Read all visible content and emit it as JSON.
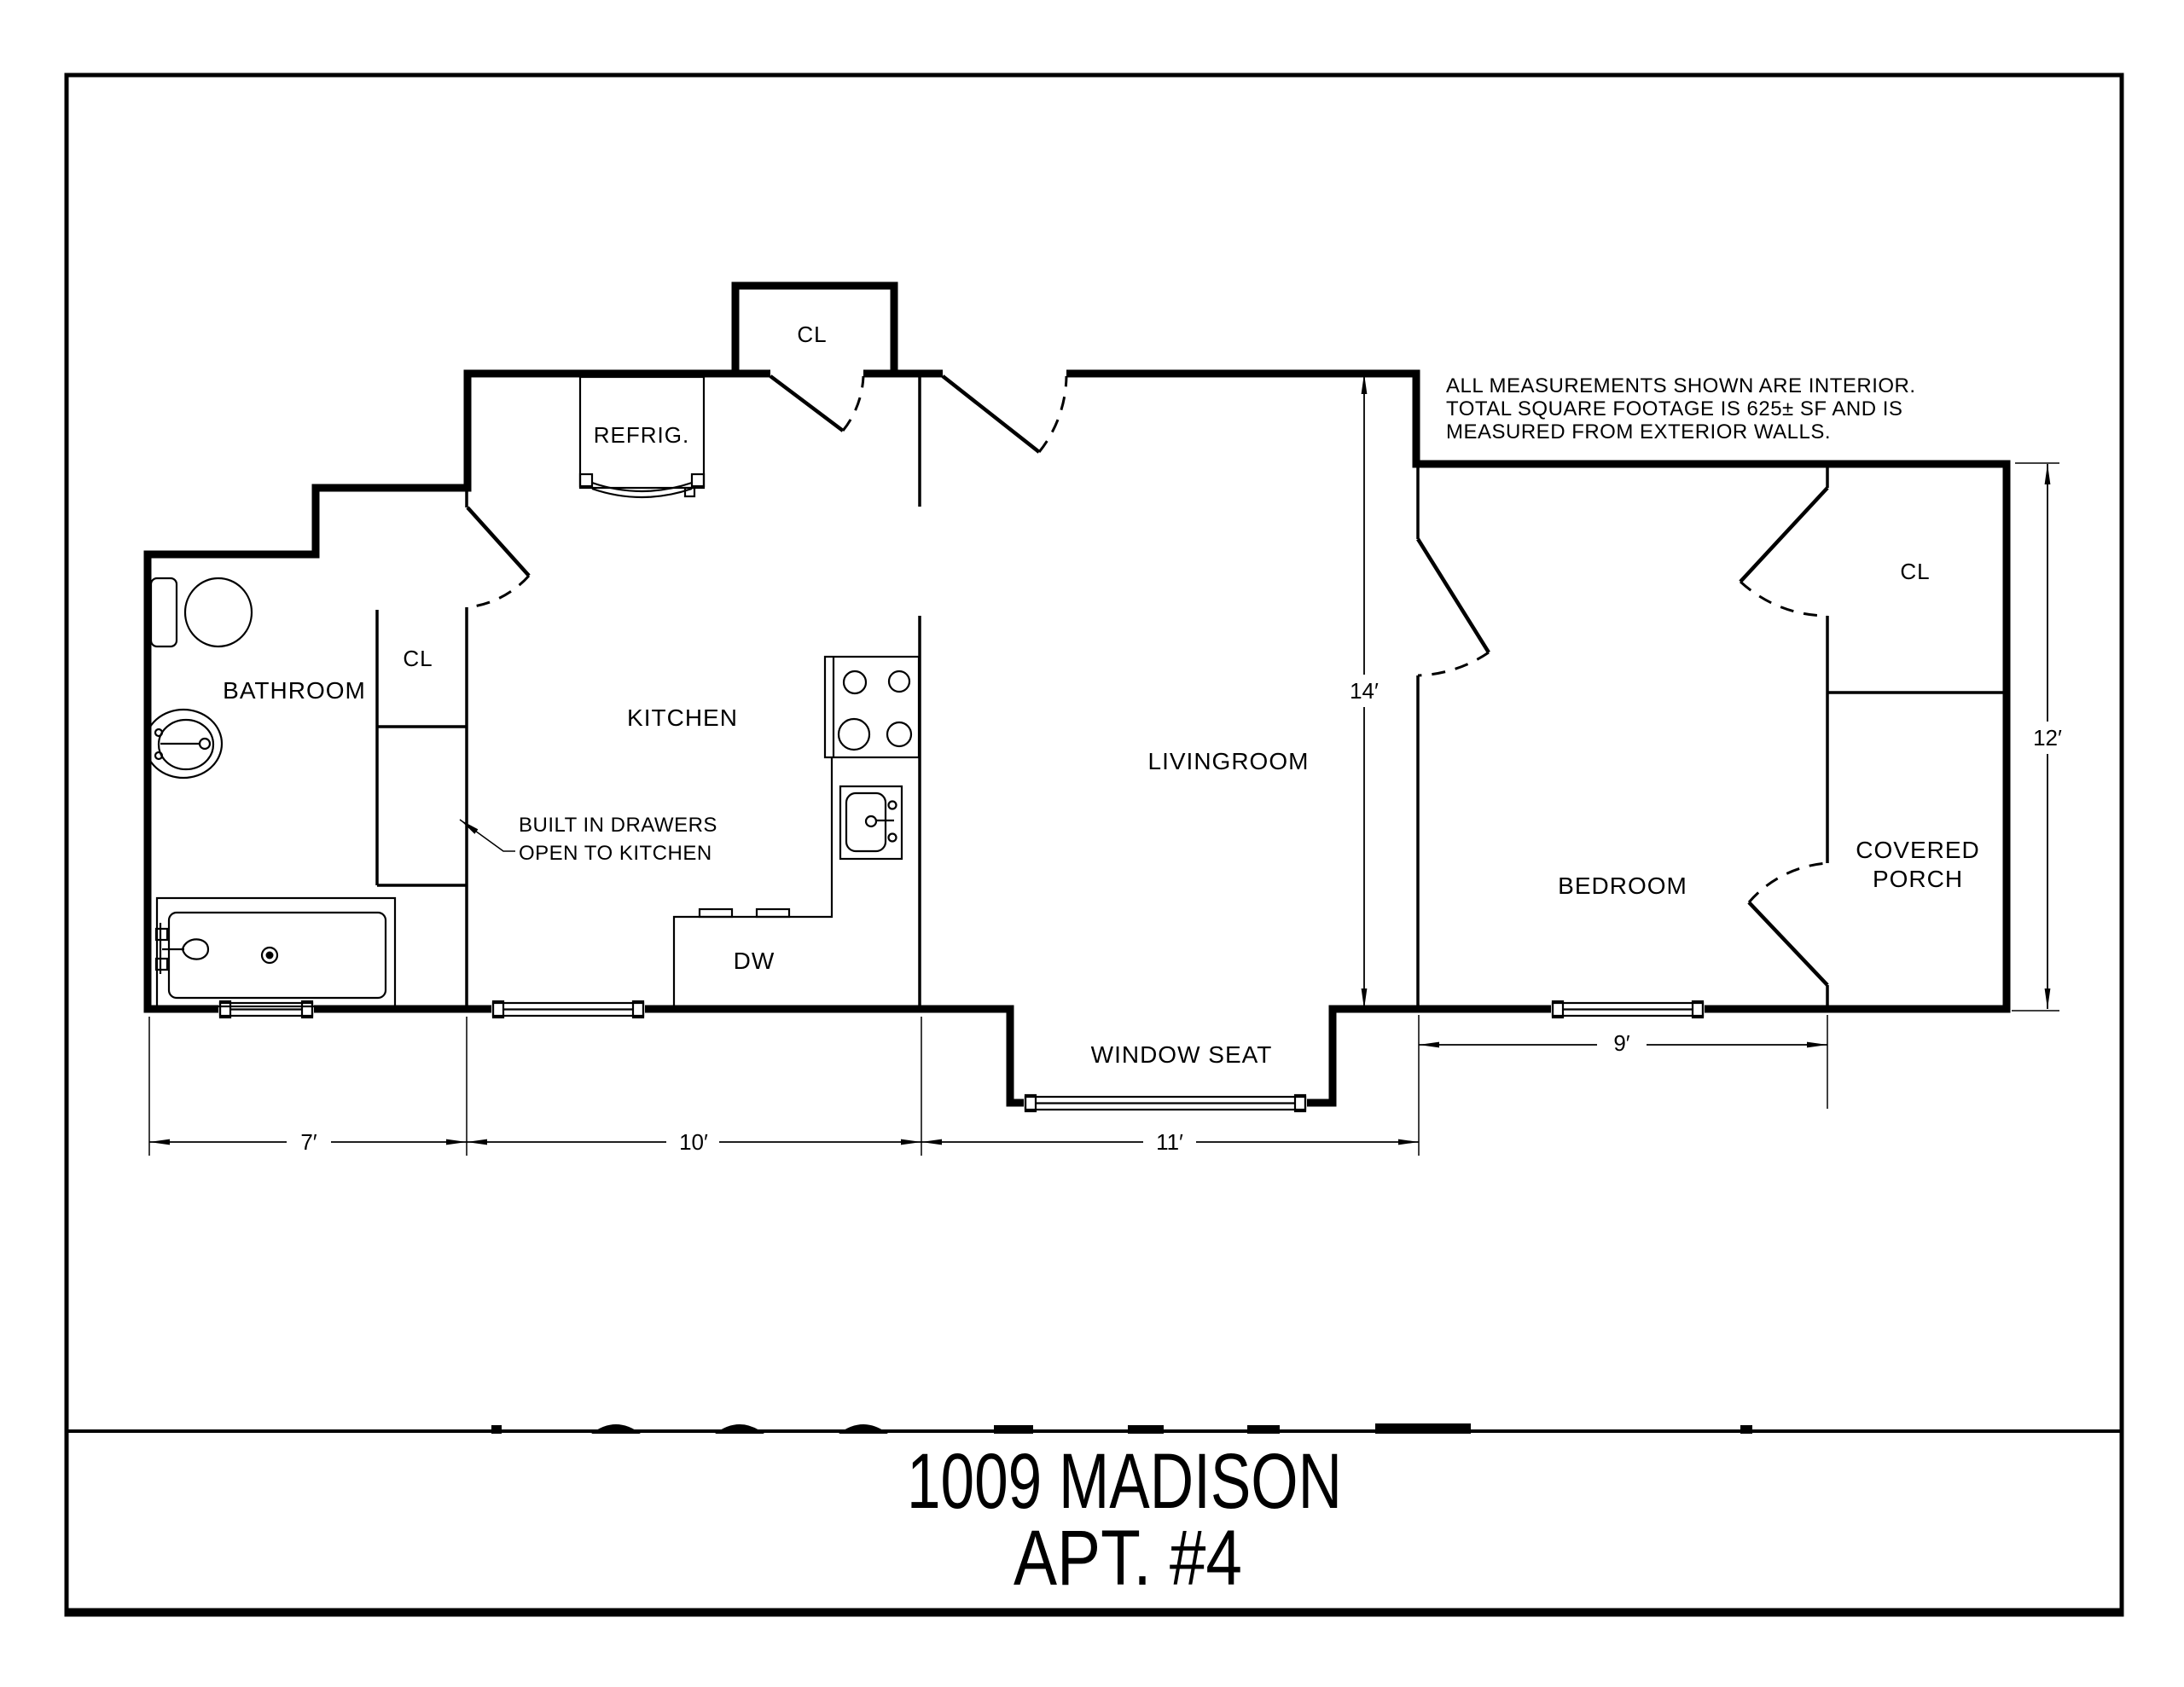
{
  "floor_plan": {
    "note": {
      "line1": "ALL MEASUREMENTS SHOWN ARE INTERIOR.",
      "line2": "TOTAL SQUARE FOOTAGE IS 625± SF  AND IS",
      "line3": "MEASURED FROM EXTERIOR WALLS."
    },
    "rooms": {
      "bathroom": "BATHROOM",
      "bathroom_closet": "CL",
      "kitchen": "KITCHEN",
      "entry_closet": "CL",
      "livingroom": "LIVINGROOM",
      "window_seat": "WINDOW SEAT",
      "bedroom": "BEDROOM",
      "bedroom_closet": "CL",
      "covered_porch_line1": "COVERED",
      "covered_porch_line2": "PORCH"
    },
    "fixtures": {
      "refrigerator": "REFRIG.",
      "dishwasher": "DW"
    },
    "annotations": {
      "drawers_line1": "BUILT IN DRAWERS",
      "drawers_line2": "OPEN TO KITCHEN"
    },
    "dimensions": {
      "bathroom_width": "7′",
      "kitchen_width": "10′",
      "livingroom_width": "11′",
      "livingroom_depth": "14′",
      "right_side_depth": "12′",
      "bedroom_width": "9′"
    }
  },
  "title_block": {
    "address": "1009 MADISON",
    "apartment": "APT. #4"
  },
  "colors": {
    "line": "#000000",
    "background": "#ffffff"
  }
}
